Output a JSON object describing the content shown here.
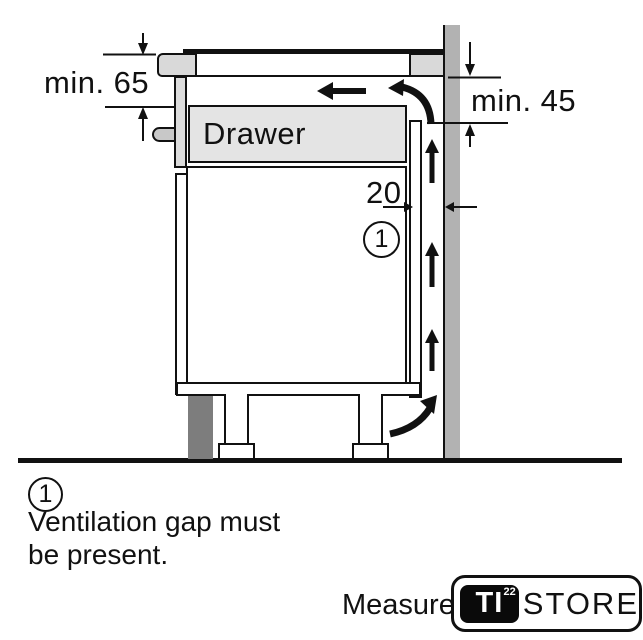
{
  "diagram": {
    "dimensions": {
      "top_left": "min. 65",
      "top_right": "min. 45",
      "gap": "20"
    },
    "drawer_label": "Drawer",
    "callout_number": "1"
  },
  "legend": {
    "number": "1",
    "line1": "Ventilation gap must",
    "line2": "be present."
  },
  "footer": {
    "measure_label": "Measure",
    "logo": {
      "ti": "TI",
      "sup": "22",
      "store": "STORE"
    }
  },
  "colors": {
    "wall": "#b2b2b2",
    "worktop_gray": "#d9d9d9",
    "drawer_fill": "#e4e4e4",
    "front_panel": "#dcdcdc",
    "plinth": "#7d7d7d",
    "line": "#111111"
  }
}
